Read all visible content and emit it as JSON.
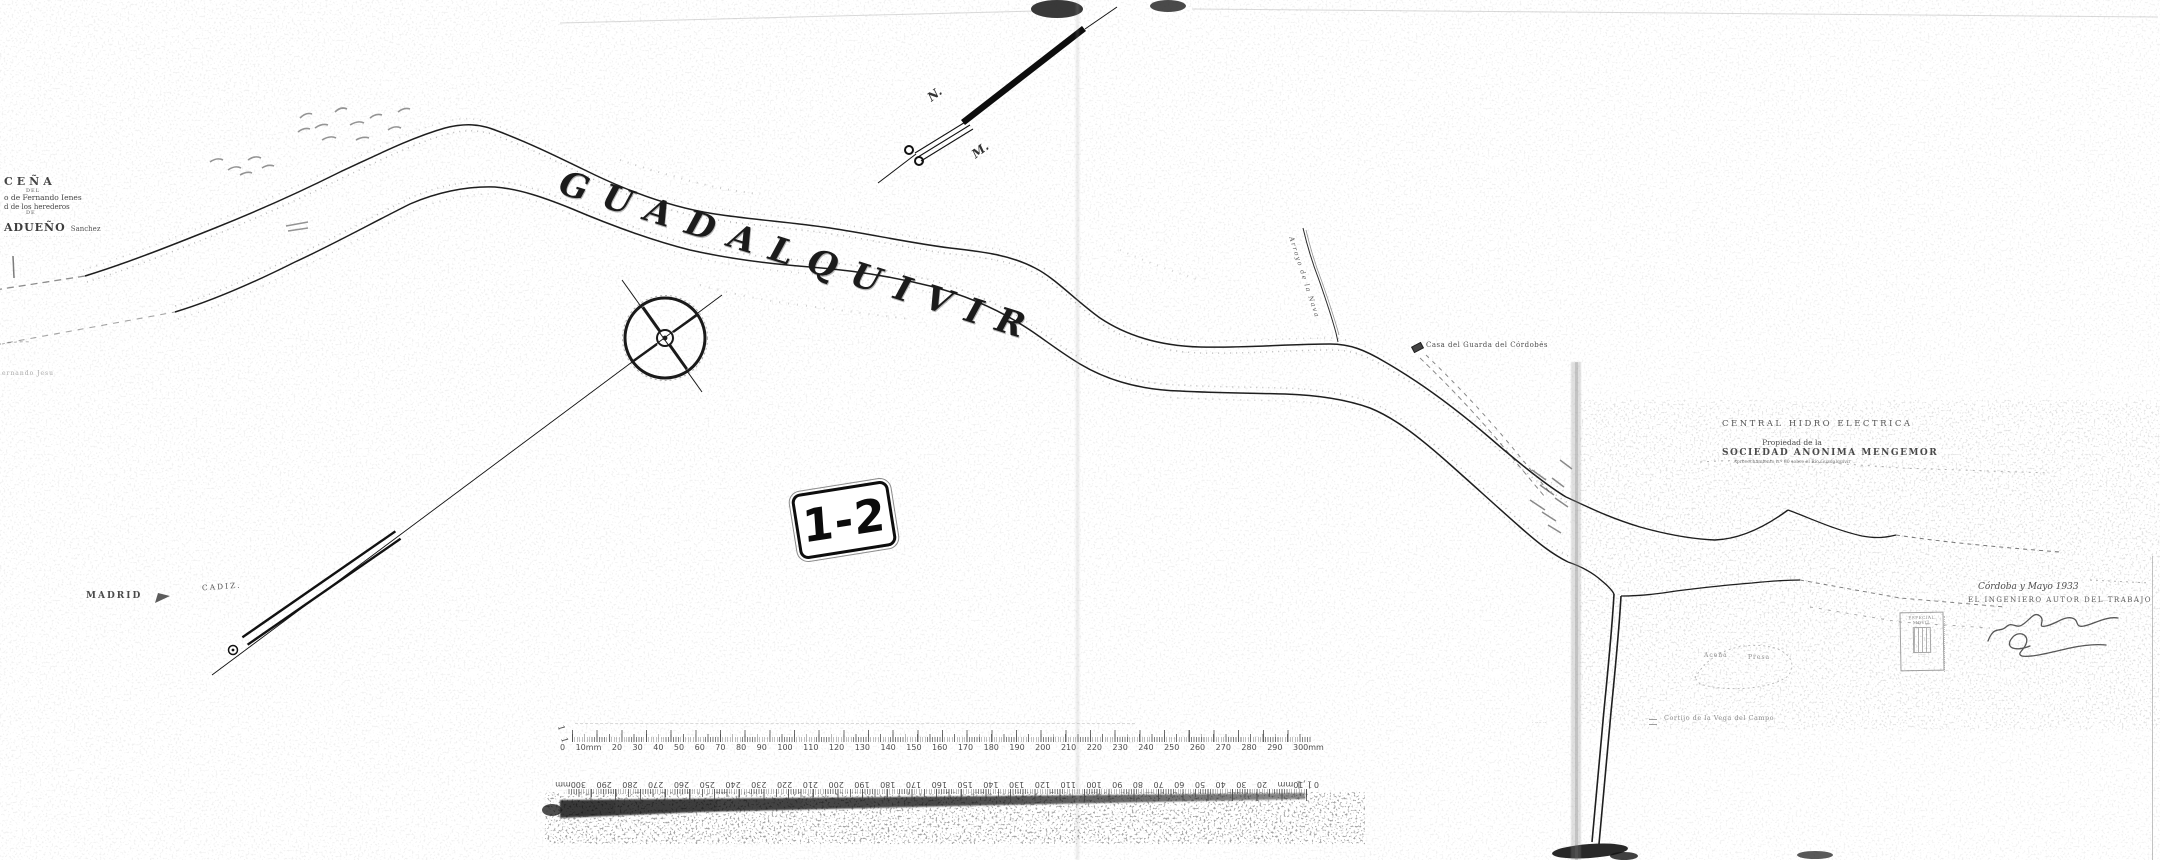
{
  "colors": {
    "ink": "#1c1c1c",
    "paper": "#ffffff"
  },
  "map": {
    "river_name": "GUADALQUIVIR",
    "sheet_label": "1-2",
    "north_labels": {
      "n": "N.",
      "m": "M."
    },
    "left_note": {
      "title": "CEÑA",
      "sub1": "DEL",
      "line1": "o de Fernando Ienes",
      "line2": "d de los herederos",
      "sub2": "DE",
      "owner": "ADUEÑO",
      "owner_suffix": "Sanchez",
      "fine_print": "·· ···· ········ · ·· ······ ··"
    },
    "faint_note": "ernando  Jesu",
    "route_labels": {
      "madrid": "MADRID",
      "cadiz": "CADIZ."
    },
    "feature_labels": {
      "casa_guarda": "Casa del Guarda del Córdobés",
      "arroyo": "Arroyo de la Nava",
      "acena": "Aceña",
      "presa": "Presa",
      "cortijo": "Cortijo de la Vega del Campo",
      "illegible_small": "· ···· ··"
    },
    "title_block": {
      "line1": "CENTRAL HIDRO ELECTRICA",
      "line1_sub": "·················  ········",
      "line2": "Propiedad de la",
      "line3": "SOCIEDAD ANONIMA MENGEMOR",
      "line4": "Aprovechamiento n.º 80 sobre el Río Guadalquivir"
    },
    "signature_block": {
      "place_date": "Córdoba y Mayo 1933",
      "role": "EL INGENIERO AUTOR DEL TRABAJO"
    },
    "stamp": {
      "header": "ESPECIAL MOVIL",
      "footer": "·· ····"
    },
    "scale": {
      "left_mark": "1 1",
      "right_mark": "1,1",
      "tick_labels": [
        "0",
        "10mm",
        "20",
        "30",
        "40",
        "50",
        "60",
        "70",
        "80",
        "90",
        "100",
        "110",
        "120",
        "130",
        "140",
        "150",
        "160",
        "170",
        "180",
        "190",
        "200",
        "210",
        "220",
        "230",
        "240",
        "250",
        "260",
        "270",
        "280",
        "290",
        "300mm"
      ]
    }
  }
}
